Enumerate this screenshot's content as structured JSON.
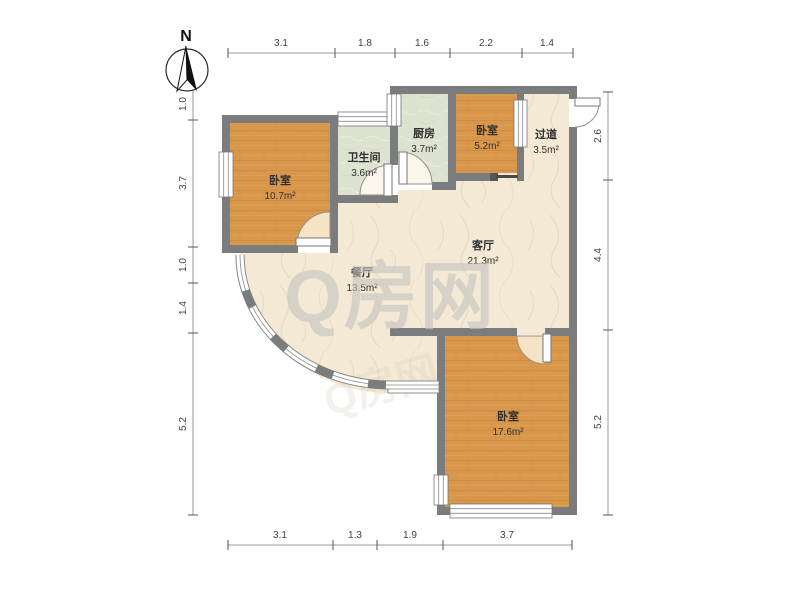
{
  "north": {
    "label": "N"
  },
  "watermark": {
    "text": "Q房网",
    "color": "#c7c5c1",
    "faint_color": "#d9cfbc"
  },
  "rooms": [
    {
      "name": "bedroom-left",
      "label": "卧室",
      "area": "10.7m²"
    },
    {
      "name": "bathroom",
      "label": "卫生间",
      "area": "3.6m²"
    },
    {
      "name": "kitchen",
      "label": "厨房",
      "area": "3.7m²"
    },
    {
      "name": "bedroom-small",
      "label": "卧室",
      "area": "5.2m²"
    },
    {
      "name": "hallway",
      "label": "过道",
      "area": "3.5m²"
    },
    {
      "name": "living-room",
      "label": "客厅",
      "area": "21.3m²"
    },
    {
      "name": "dining-room",
      "label": "餐厅",
      "area": "13.5m²"
    },
    {
      "name": "bedroom-bottom",
      "label": "卧室",
      "area": "17.6m²"
    }
  ],
  "dimensions": {
    "top": [
      "3.1",
      "1.8",
      "1.6",
      "2.2",
      "1.4"
    ],
    "bottom": [
      "3.1",
      "1.3",
      "1.9",
      "3.7"
    ],
    "left": [
      "1.0",
      "3.7",
      "1.0",
      "1.4",
      "5.2"
    ],
    "right": [
      "2.6",
      "4.4",
      "5.2"
    ]
  },
  "colors": {
    "wall": "#7b7c7e",
    "wood_floor": "#d8974b",
    "tile_floor": "#dde2d1",
    "living_floor": "#f3e9d5",
    "door_swing_fill": "#f6e3c5",
    "dimension_text": "#3f3f3f"
  }
}
